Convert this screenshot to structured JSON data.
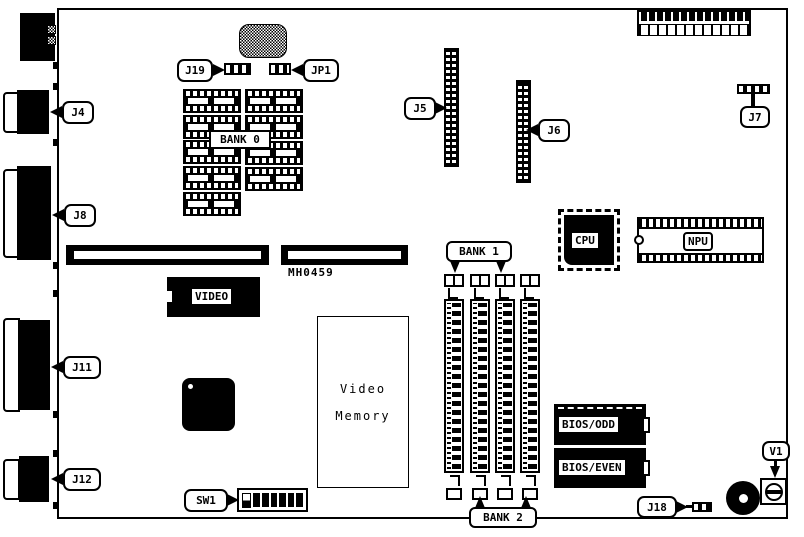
{
  "board": {
    "id_text": "MH0459",
    "callouts": {
      "j4": "J4",
      "j5": "J5",
      "j6": "J6",
      "j7": "J7",
      "j8": "J8",
      "j11": "J11",
      "j12": "J12",
      "j18": "J18",
      "j19": "J19",
      "jp1": "JP1",
      "sw1": "SW1",
      "v1": "V1"
    },
    "memory_banks": {
      "bank0": "BANK 0",
      "bank1": "BANK 1",
      "bank2": "BANK 2"
    },
    "chips": {
      "cpu": "CPU",
      "npu": "NPU",
      "video": "VIDEO",
      "bios_odd": "BIOS/ODD",
      "bios_even": "BIOS/EVEN"
    },
    "regions": {
      "video_memory": [
        "Video",
        "Memory"
      ]
    },
    "colors": {
      "ink": "#000000",
      "paper": "#ffffff"
    }
  }
}
